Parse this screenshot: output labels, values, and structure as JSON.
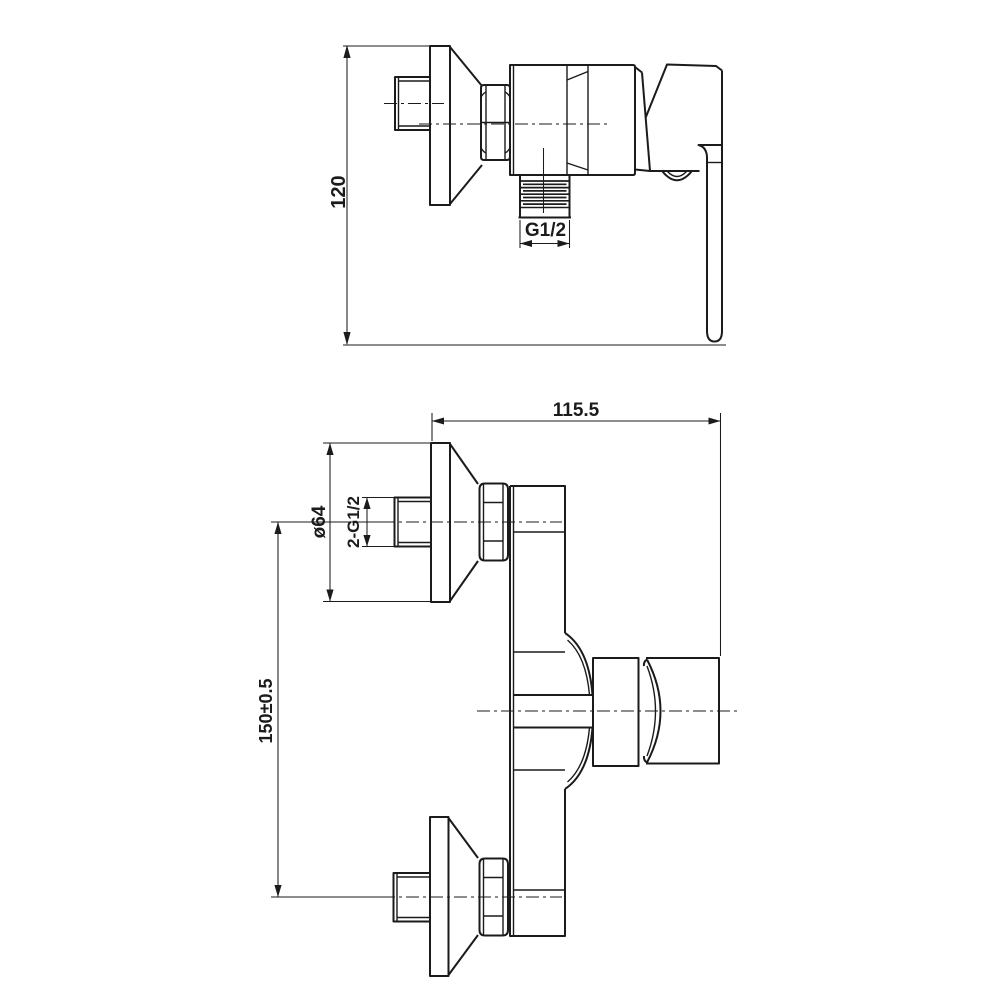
{
  "page": {
    "background": "#ffffff",
    "line_color": "#1b1b1b"
  },
  "views": {
    "side": {
      "dim_height": "120",
      "dim_outlet_thread": "G1/2"
    },
    "front": {
      "dim_width": "115.5",
      "dim_flange_diameter": "ø64",
      "dim_inlet_thread": "2-G1/2",
      "dim_center_distance": "150±0.5"
    }
  }
}
